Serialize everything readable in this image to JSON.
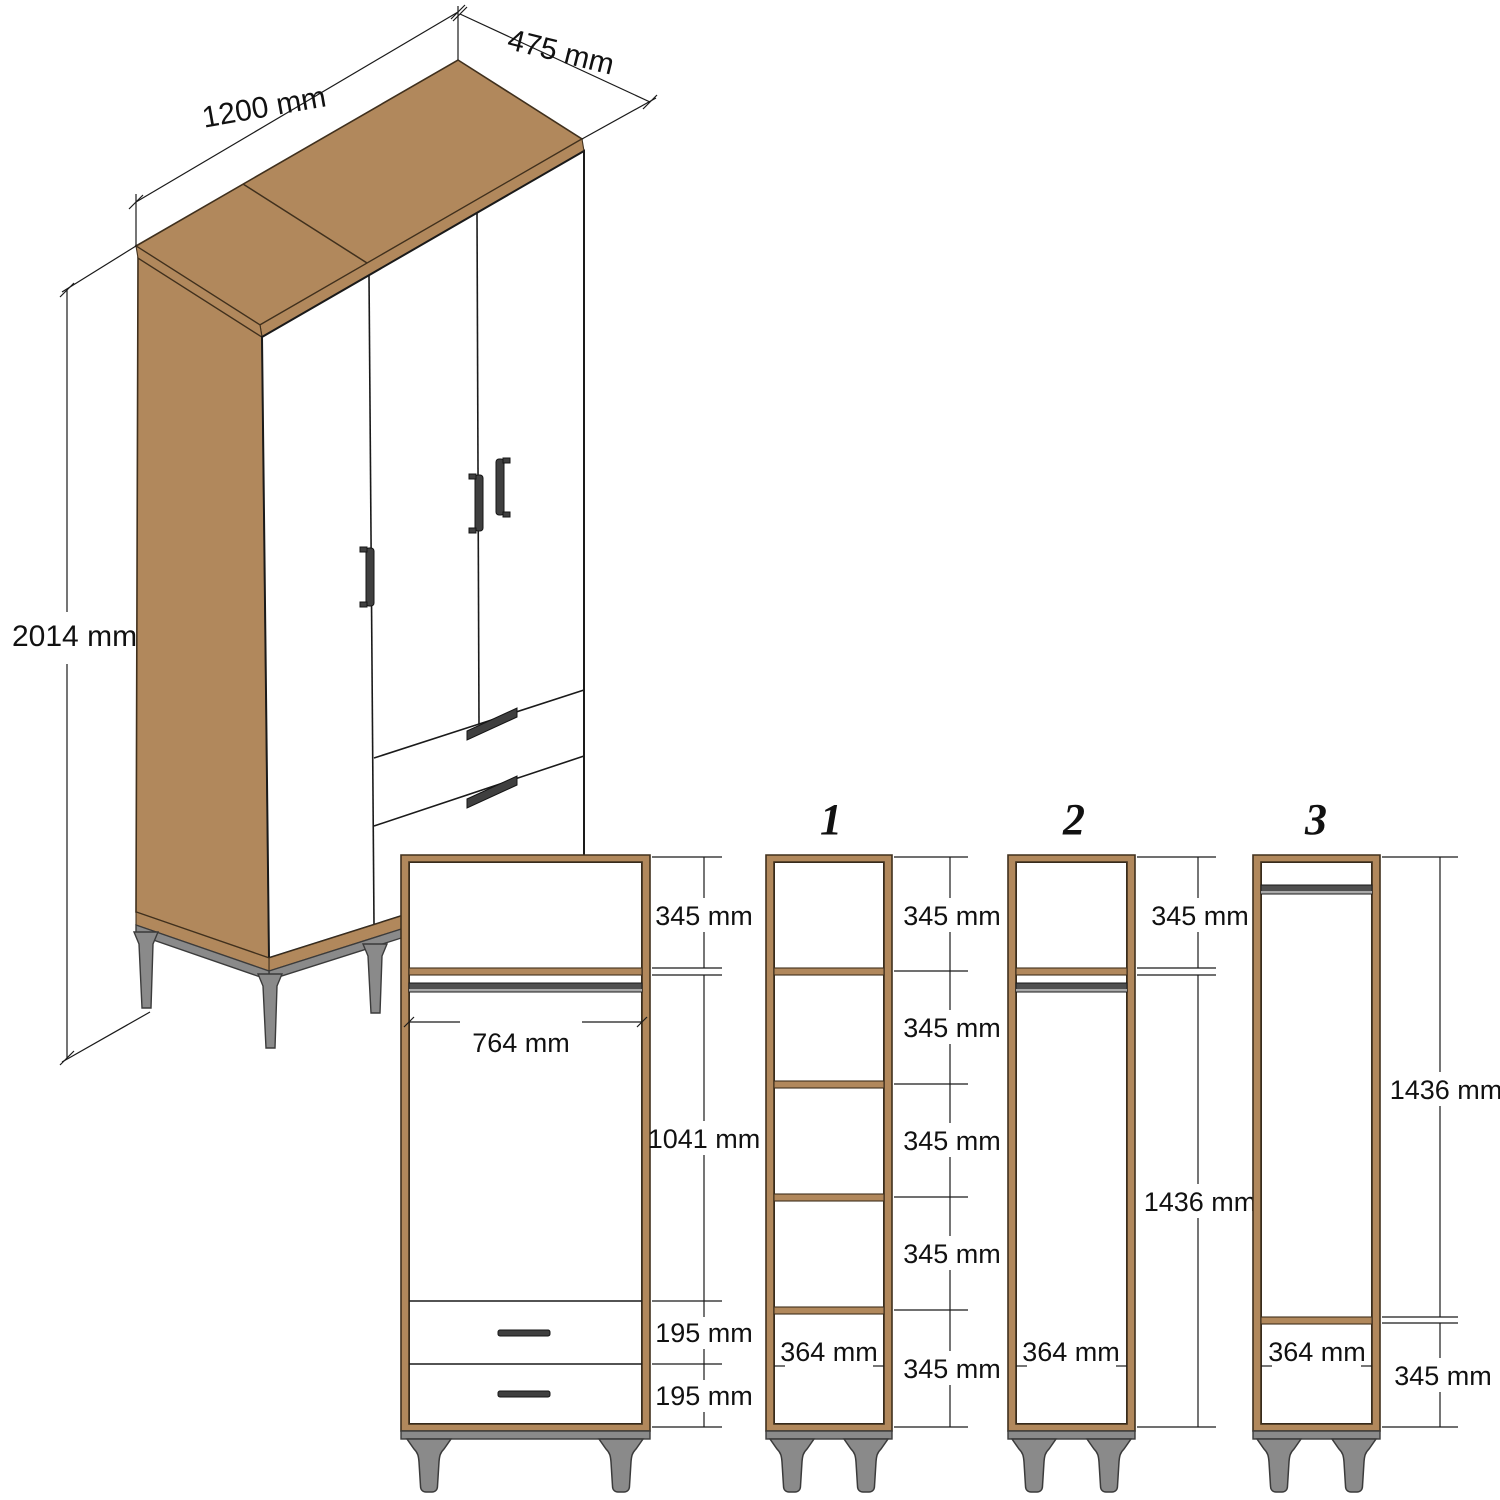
{
  "drawing": {
    "type": "wardrobe-dimension-diagram",
    "unit": "mm"
  },
  "colors": {
    "wood": "#b1885c",
    "wood_edge": "#40301d",
    "outline": "#1a1a1a",
    "metal": "#8a8a8a",
    "rail": "#4f4f4f",
    "handle": "#3f3f3f",
    "background": "#ffffff"
  },
  "isometric": {
    "height_label": "2014 mm",
    "width_label": "1200 mm",
    "depth_label": "475 mm"
  },
  "front_view": {
    "hanging_width_label": "764 mm",
    "dims": [
      "345 mm",
      "1041 mm",
      "195 mm",
      "195 mm"
    ]
  },
  "sections": [
    {
      "number": "1",
      "width_label": "364 mm",
      "dims": [
        "345 mm",
        "345 mm",
        "345 mm",
        "345 mm",
        "345 mm"
      ]
    },
    {
      "number": "2",
      "width_label": "364 mm",
      "dims": [
        "345 mm",
        "1436 mm"
      ]
    },
    {
      "number": "3",
      "width_label": "364 mm",
      "dims": [
        "1436 mm",
        "345 mm"
      ]
    }
  ]
}
